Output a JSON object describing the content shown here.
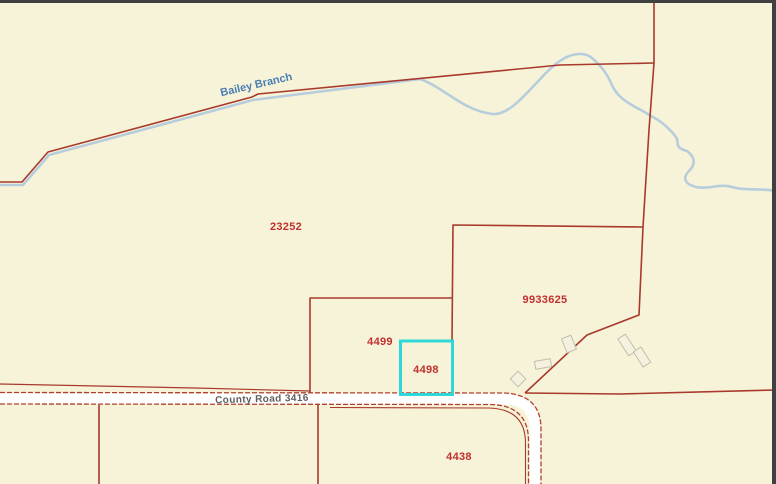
{
  "map": {
    "stream_label": "Bailey Branch",
    "road_label": "County Road 3416",
    "parcels": [
      {
        "id": "23252"
      },
      {
        "id": "9933625"
      },
      {
        "id": "4499"
      },
      {
        "id": "4498"
      },
      {
        "id": "4438"
      }
    ],
    "selected_parcel_id": "4498",
    "colors": {
      "background": "#f7f3d8",
      "parcel_line": "#a8392c",
      "parcel_label": "#c03030",
      "stream": "#b7cddc",
      "stream_label": "#4a7fb5",
      "road_fill": "#ffffff",
      "road_edge": "#b2402e",
      "road_label": "#5f5f5f",
      "selection_highlight": "#2fd8d8",
      "building_fill": "#f4f1df",
      "building_stroke": "#c2bead",
      "frame_border": "#404040"
    }
  }
}
